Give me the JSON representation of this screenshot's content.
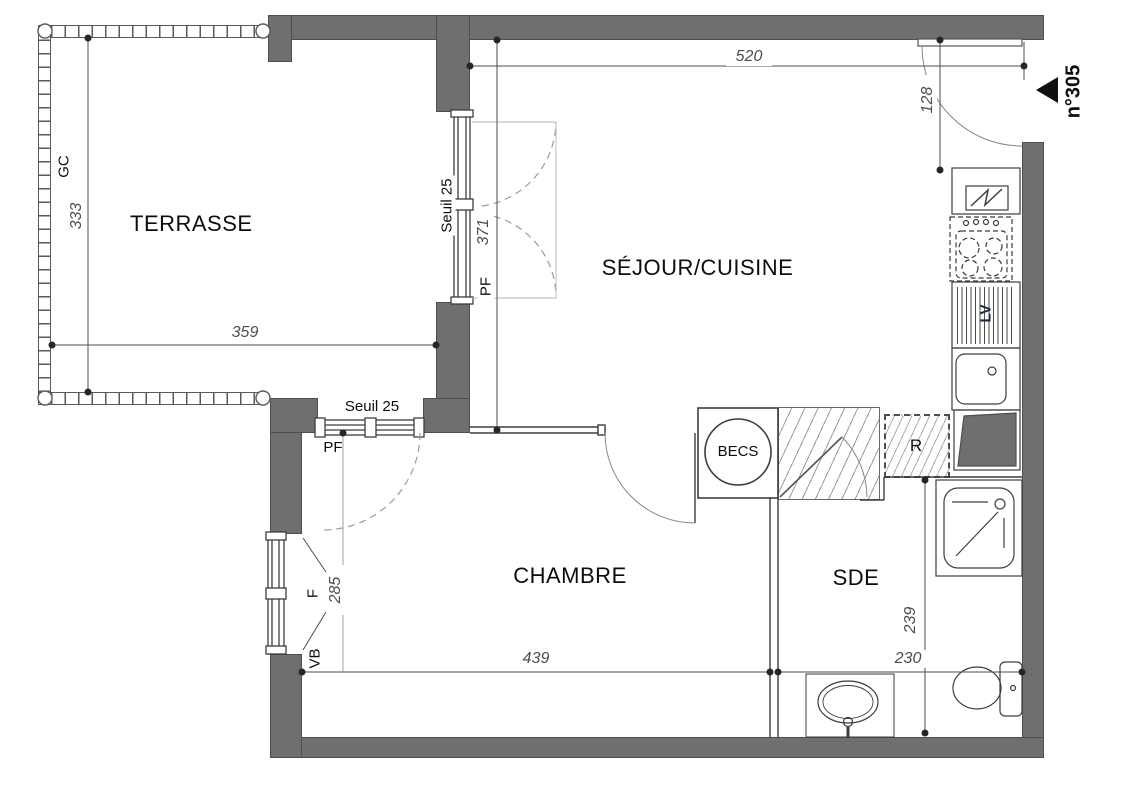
{
  "plan": {
    "unit_label": "n°305",
    "rooms": {
      "terrasse": "TERRASSE",
      "sejour_cuisine": "SÉJOUR/CUISINE",
      "chambre": "CHAMBRE",
      "sde": "SDE"
    },
    "equipment": {
      "water_heater": "BECS",
      "storage": "R",
      "dishwasher": "LV"
    },
    "openings": {
      "guardrail": "GC",
      "threshold_east": "Seuil 25",
      "french_window_east": "PF",
      "threshold_south": "Seuil 25",
      "french_window_south": "PF",
      "window": "F",
      "vb": "VB"
    },
    "dimensions_cm": {
      "sejour_width": "520",
      "entry_recess": "128",
      "sejour_depth": "371",
      "terrasse_depth": "333",
      "terrasse_width": "359",
      "chambre_width": "439",
      "chambre_window": "285",
      "sde_depth": "239",
      "sde_width": "230"
    },
    "colors": {
      "wall": "#6f6f6f",
      "line": "#3d3d3d",
      "dimension": "#4d4d4d",
      "dashed": "#9b9b9b",
      "text": "#141414"
    }
  }
}
